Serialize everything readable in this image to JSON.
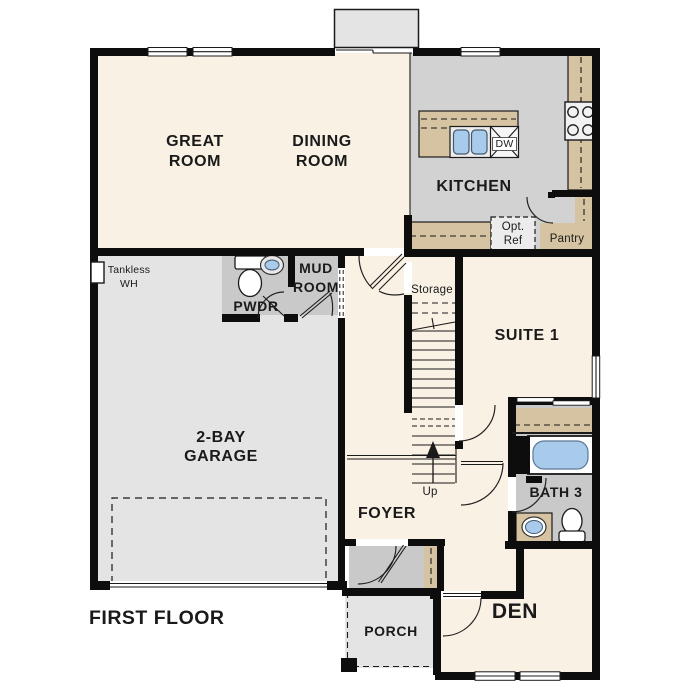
{
  "title": "FIRST FLOOR",
  "palette": {
    "wall_black": "#0d0d0d",
    "floor_cream": "#f9f1e4",
    "floor_gray": "#d2d2d2",
    "floor_light_gray": "#e4e4e4",
    "floor_mid_gray": "#c9c9c9",
    "counter_tan": "#d6c3a1",
    "fixture_blue": "#a8cbec"
  },
  "rooms": {
    "great_room": {
      "line1": "GREAT",
      "line2": "ROOM"
    },
    "dining_room": {
      "line1": "DINING",
      "line2": "ROOM"
    },
    "kitchen": {
      "label": "KITCHEN"
    },
    "pwdr": {
      "label": "PWDR"
    },
    "mud_room": {
      "line1": "MUD",
      "line2": "ROOM"
    },
    "suite_1": {
      "label": "SUITE 1"
    },
    "garage": {
      "line1": "2-BAY",
      "line2": "GARAGE"
    },
    "foyer": {
      "label": "FOYER"
    },
    "bath_3": {
      "label": "BATH 3"
    },
    "den": {
      "label": "DEN"
    },
    "porch": {
      "label": "PORCH"
    },
    "pantry": {
      "label": "Pantry"
    },
    "storage": {
      "label": "Storage"
    }
  },
  "annotations": {
    "tankless_wh": {
      "line1": "Tankless",
      "line2": "WH"
    },
    "opt_ref": {
      "line1": "Opt.",
      "line2": "Ref"
    },
    "dw": {
      "label": "DW"
    },
    "up": {
      "label": "Up"
    }
  }
}
